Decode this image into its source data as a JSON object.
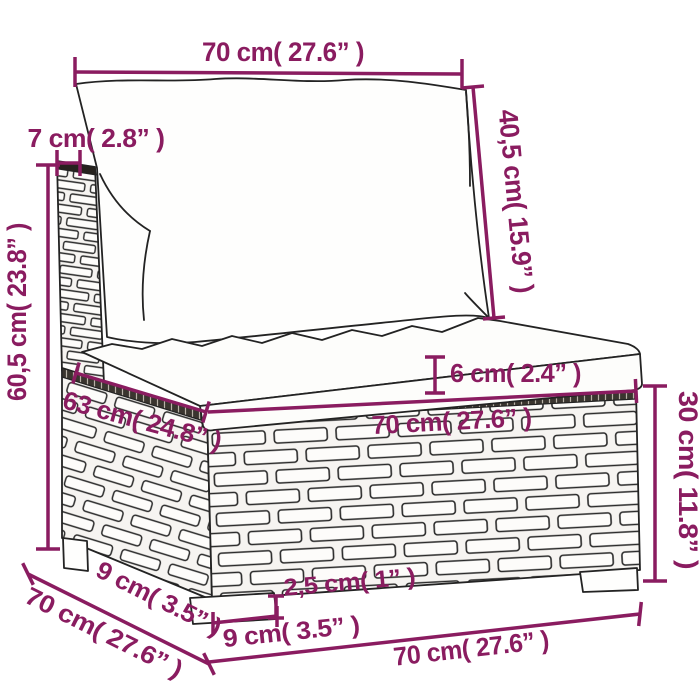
{
  "diagram": {
    "type": "product-dimension-diagram",
    "subject": "rattan-sofa-middle-section-with-cushions",
    "accent_color": "#8a1c60",
    "line_color": "#232323",
    "background_color": "#ffffff",
    "dimensions": {
      "top_width": "70 cm( 27.6” )",
      "back_thickness": "7 cm( 2.8” )",
      "back_cushion_height": "40,5 cm( 15.9” )",
      "total_height": "60,5 cm( 23.8” )",
      "seat_cushion_thickness": "6 cm( 2.4” )",
      "seat_depth_top": "63 cm( 24.8” )",
      "seat_width_front": "70 cm( 27.6” )",
      "base_height": "30 cm( 11.8” )",
      "foot_inset_diagonal": "9 cm( 3.5” )",
      "base_depth_diagonal": "70 cm( 27.6” )",
      "foot_height": "2,5 cm( 1” )",
      "foot_width": "9 cm( 3.5” )",
      "bottom_width": "70 cm( 27.6” )"
    }
  }
}
